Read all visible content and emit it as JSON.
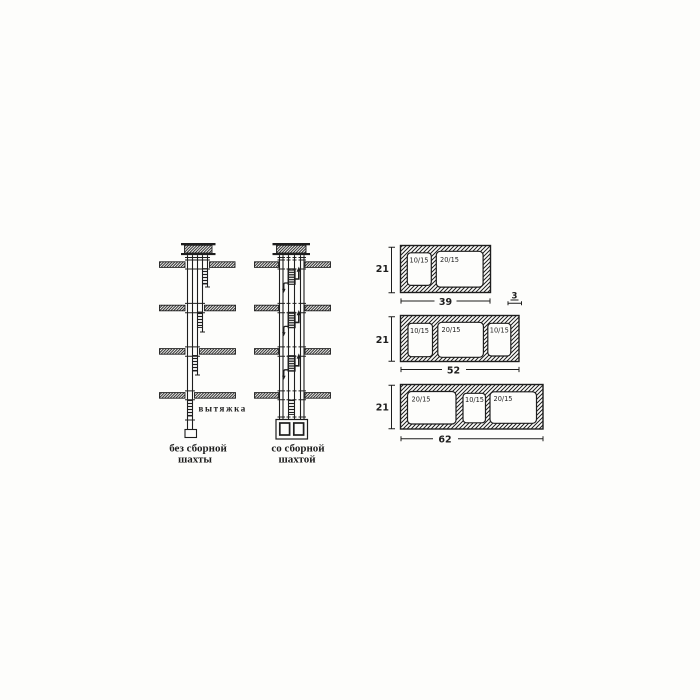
{
  "colors": {
    "ink": "#1e1e1e",
    "paper": "#fdfdfb"
  },
  "left_panel": {
    "exhaust_label": "вытяжка",
    "without_collector": {
      "caption_line1": "без сборной",
      "caption_line2": "шахты"
    },
    "with_collector": {
      "caption_line1": "со сборной",
      "caption_line2": "шахтой"
    }
  },
  "blocks_panel": {
    "wall_thickness_label": "3",
    "blocks": [
      {
        "height_label": "21",
        "width_label": "39",
        "cells": [
          "10/15",
          "20/15"
        ]
      },
      {
        "height_label": "21",
        "width_label": "52",
        "cells": [
          "10/15",
          "20/15",
          "10/15"
        ]
      },
      {
        "height_label": "21",
        "width_label": "62",
        "cells": [
          "20/15",
          "10/15",
          "20/15"
        ]
      }
    ]
  }
}
